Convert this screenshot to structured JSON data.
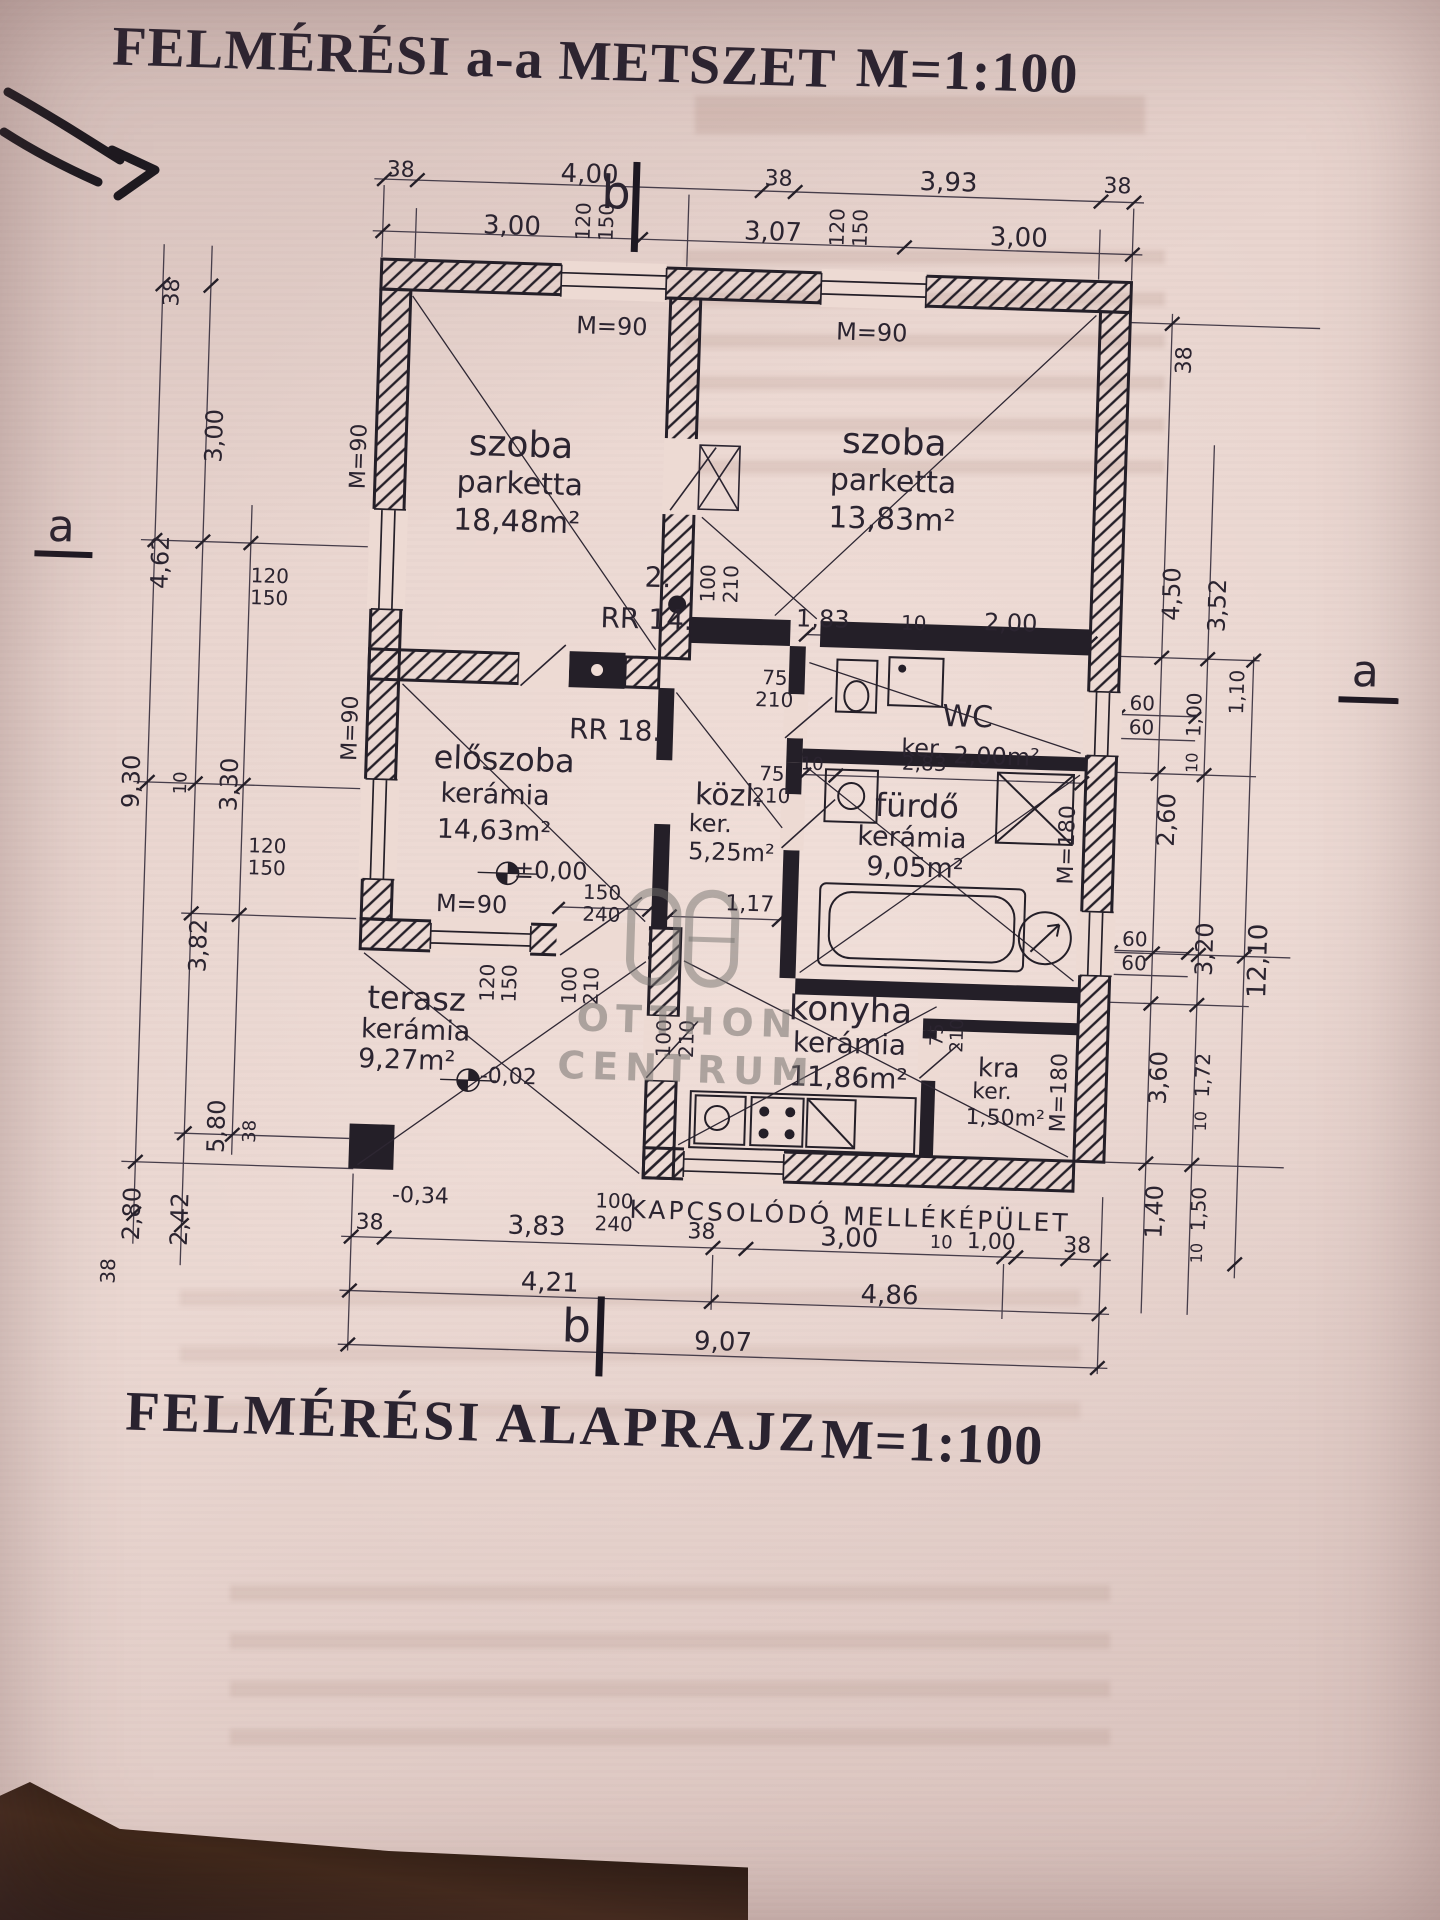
{
  "titles": {
    "top": "FELMÉRÉSI  a-a METSZET",
    "top_scale": "M=1:100",
    "bottom": "FELMÉRÉSI ALAPRAJZ",
    "bottom_scale": "M=1:100"
  },
  "watermark": {
    "word1": "OTTHON",
    "word2": "CENTRUM"
  },
  "plan_labels": [
    {
      "name": "dim-top-38-1",
      "text": "38",
      "x": 376,
      "y": 181,
      "size": 22
    },
    {
      "name": "dim-top-400",
      "text": "4,00",
      "x": 565,
      "y": 179,
      "size": 26
    },
    {
      "name": "dim-top-38-2",
      "text": "38",
      "x": 754,
      "y": 178,
      "size": 22
    },
    {
      "name": "dim-top-393",
      "text": "3,93",
      "x": 924,
      "y": 176,
      "size": 26
    },
    {
      "name": "dim-top-38-3",
      "text": "38",
      "x": 1093,
      "y": 175,
      "size": 22
    },
    {
      "name": "dim-top-300-1",
      "text": "3,00",
      "x": 489,
      "y": 233,
      "size": 26
    },
    {
      "name": "dim-top-307",
      "text": "3,07",
      "x": 750,
      "y": 231,
      "size": 26
    },
    {
      "name": "dim-top-300-2",
      "text": "3,00",
      "x": 996,
      "y": 229,
      "size": 26
    },
    {
      "name": "marker-b-top",
      "text": "b",
      "x": 592,
      "y": 196,
      "size": 46,
      "cls": "hand"
    },
    {
      "name": "win-top-left-120",
      "text": "120",
      "x": 560,
      "y": 226,
      "rot": 1,
      "size": 20
    },
    {
      "name": "win-top-left-150",
      "text": "150",
      "x": 583,
      "y": 226,
      "rot": 1,
      "size": 20
    },
    {
      "name": "win-top-right-120",
      "text": "120",
      "x": 814,
      "y": 224,
      "rot": 1,
      "size": 20
    },
    {
      "name": "win-top-right-150",
      "text": "150",
      "x": 837,
      "y": 224,
      "rot": 1,
      "size": 20
    },
    {
      "name": "lintel-top-left",
      "text": "M=90",
      "x": 592,
      "y": 330,
      "size": 24
    },
    {
      "name": "lintel-top-right",
      "text": "M=90",
      "x": 852,
      "y": 328,
      "size": 24
    },
    {
      "name": "dim-left-38-1",
      "text": "38",
      "x": 152,
      "y": 310,
      "rot": 1,
      "size": 22
    },
    {
      "name": "dim-left-300",
      "text": "3,00",
      "x": 198,
      "y": 452,
      "rot": 1,
      "size": 24
    },
    {
      "name": "dim-left-462",
      "text": "4,62",
      "x": 148,
      "y": 580,
      "rot": 1,
      "size": 24
    },
    {
      "name": "win-left-upper-120",
      "text": "120",
      "x": 258,
      "y": 590,
      "size": 20
    },
    {
      "name": "win-left-upper-150",
      "text": "150",
      "x": 258,
      "y": 612,
      "size": 20
    },
    {
      "name": "dim-left-930",
      "text": "9,30",
      "x": 126,
      "y": 800,
      "rot": 1,
      "size": 24
    },
    {
      "name": "dim-left-10",
      "text": "10",
      "x": 176,
      "y": 800,
      "rot": 1,
      "size": 18
    },
    {
      "name": "dim-left-330",
      "text": "3,30",
      "x": 224,
      "y": 800,
      "rot": 1,
      "size": 24
    },
    {
      "name": "win-left-lower-120",
      "text": "120",
      "x": 264,
      "y": 860,
      "size": 20
    },
    {
      "name": "win-left-lower-150",
      "text": "150",
      "x": 264,
      "y": 882,
      "size": 20
    },
    {
      "name": "dim-left-382",
      "text": "3,82",
      "x": 198,
      "y": 962,
      "rot": 1,
      "size": 24
    },
    {
      "name": "dim-left-580",
      "text": "5,80",
      "x": 222,
      "y": 1142,
      "rot": 1,
      "size": 24
    },
    {
      "name": "dim-left-38-2",
      "text": "38",
      "x": 256,
      "y": 1146,
      "rot": 1,
      "size": 18
    },
    {
      "name": "dim-left-280",
      "text": "2,80",
      "x": 140,
      "y": 1232,
      "rot": 1,
      "size": 24
    },
    {
      "name": "dim-left-242",
      "text": "2,42",
      "x": 188,
      "y": 1236,
      "rot": 1,
      "size": 24
    },
    {
      "name": "dim-left-38-3",
      "text": "38",
      "x": 118,
      "y": 1290,
      "rot": 1,
      "size": 20
    },
    {
      "name": "marker-a-left",
      "text": "a",
      "x": 48,
      "y": 548,
      "size": 44,
      "cls": "hand"
    },
    {
      "name": "wall-left-M90-upper",
      "text": "M=90",
      "x": 344,
      "y": 468,
      "rot": 1,
      "size": 22
    },
    {
      "name": "wall-left-M90-lower",
      "text": "M=90",
      "x": 344,
      "y": 740,
      "rot": 1,
      "size": 22
    },
    {
      "name": "dim-right-38",
      "text": "38",
      "x": 1166,
      "y": 346,
      "rot": 1,
      "size": 22
    },
    {
      "name": "dim-right-450",
      "text": "4,50",
      "x": 1160,
      "y": 580,
      "rot": 1,
      "size": 24
    },
    {
      "name": "dim-right-352",
      "text": "3,52",
      "x": 1206,
      "y": 590,
      "rot": 1,
      "size": 24
    },
    {
      "name": "win-right-wc-60a",
      "text": "60",
      "x": 1134,
      "y": 690,
      "size": 20
    },
    {
      "name": "win-right-wc-60b",
      "text": "60",
      "x": 1134,
      "y": 714,
      "size": 20
    },
    {
      "name": "dim-right-100",
      "text": "1,00",
      "x": 1186,
      "y": 700,
      "rot": 1,
      "size": 20
    },
    {
      "name": "dim-right-110",
      "text": "1,10",
      "x": 1228,
      "y": 676,
      "rot": 1,
      "size": 20
    },
    {
      "name": "dim-right-10-1",
      "text": "10",
      "x": 1186,
      "y": 748,
      "rot": 1,
      "size": 16
    },
    {
      "name": "dim-right-260",
      "text": "2,60",
      "x": 1162,
      "y": 806,
      "rot": 1,
      "size": 24
    },
    {
      "name": "win-right-k-60a",
      "text": "60",
      "x": 1134,
      "y": 926,
      "size": 20
    },
    {
      "name": "win-right-k-60b",
      "text": "60",
      "x": 1134,
      "y": 950,
      "size": 20
    },
    {
      "name": "dim-right-320",
      "text": "3,20",
      "x": 1204,
      "y": 934,
      "rot": 1,
      "size": 24
    },
    {
      "name": "dim-right-1210",
      "text": "12,10",
      "x": 1258,
      "y": 944,
      "rot": 1,
      "size": 26
    },
    {
      "name": "dim-right-360",
      "text": "3,60",
      "x": 1162,
      "y": 1064,
      "rot": 1,
      "size": 24
    },
    {
      "name": "dim-right-172",
      "text": "1,72",
      "x": 1206,
      "y": 1060,
      "rot": 1,
      "size": 20
    },
    {
      "name": "dim-right-10-2",
      "text": "10",
      "x": 1206,
      "y": 1106,
      "rot": 1,
      "size": 16
    },
    {
      "name": "dim-right-140",
      "text": "1,40",
      "x": 1162,
      "y": 1198,
      "rot": 1,
      "size": 24
    },
    {
      "name": "dim-right-150",
      "text": "1,50",
      "x": 1206,
      "y": 1194,
      "rot": 1,
      "size": 20
    },
    {
      "name": "dim-right-10-3",
      "text": "10",
      "x": 1206,
      "y": 1238,
      "rot": 1,
      "size": 16
    },
    {
      "name": "marker-a-right",
      "text": "a",
      "x": 1356,
      "y": 652,
      "size": 44,
      "cls": "hand"
    },
    {
      "name": "dim-bot-38-1",
      "text": "38",
      "x": 378,
      "y": 1234,
      "size": 22
    },
    {
      "name": "dim-bot-383",
      "text": "3,83",
      "x": 545,
      "y": 1232,
      "size": 26
    },
    {
      "name": "dim-bot-38-2",
      "text": "38",
      "x": 710,
      "y": 1233,
      "size": 22
    },
    {
      "name": "dim-bot-300",
      "text": "3,00",
      "x": 858,
      "y": 1234,
      "size": 26
    },
    {
      "name": "dim-bot-10",
      "text": "10",
      "x": 950,
      "y": 1236,
      "size": 18
    },
    {
      "name": "dim-bot-100",
      "text": "1,00",
      "x": 1000,
      "y": 1234,
      "size": 22
    },
    {
      "name": "dim-bot-38-3",
      "text": "38",
      "x": 1086,
      "y": 1235,
      "size": 22
    },
    {
      "name": "dim-bot-421",
      "text": "4,21",
      "x": 560,
      "y": 1288,
      "size": 26
    },
    {
      "name": "dim-bot-486",
      "text": "4,86",
      "x": 900,
      "y": 1290,
      "size": 26
    },
    {
      "name": "dim-bot-907",
      "text": "9,07",
      "x": 735,
      "y": 1342,
      "size": 26
    },
    {
      "name": "marker-b-bottom",
      "text": "b",
      "x": 588,
      "y": 1330,
      "size": 46,
      "cls": "hand"
    },
    {
      "name": "room-szoba-left-name",
      "text": "szoba",
      "x": 505,
      "y": 452,
      "size": 36
    },
    {
      "name": "room-szoba-left-floor",
      "text": "parketta",
      "x": 505,
      "y": 491,
      "size": 30
    },
    {
      "name": "room-szoba-left-area",
      "text": "18,48m²",
      "x": 503,
      "y": 529,
      "size": 30
    },
    {
      "name": "room-szoba-right-name",
      "text": "szoba",
      "x": 878,
      "y": 438,
      "size": 36
    },
    {
      "name": "room-szoba-right-floor",
      "text": "parketta",
      "x": 878,
      "y": 477,
      "size": 30
    },
    {
      "name": "room-szoba-right-area",
      "text": "13,83m²",
      "x": 878,
      "y": 515,
      "size": 30
    },
    {
      "name": "note-2",
      "text": "2.",
      "x": 646,
      "y": 580,
      "size": 28
    },
    {
      "name": "note-rr14",
      "text": "RR 14.",
      "x": 636,
      "y": 622,
      "size": 28
    },
    {
      "name": "door-center-100",
      "text": "100",
      "x": 696,
      "y": 584,
      "rot": 1,
      "size": 20
    },
    {
      "name": "door-center-210",
      "text": "210",
      "x": 719,
      "y": 584,
      "rot": 1,
      "size": 20
    },
    {
      "name": "dim-inner-183",
      "text": "1,83",
      "x": 812,
      "y": 616,
      "size": 24
    },
    {
      "name": "dim-inner-10",
      "text": "10",
      "x": 903,
      "y": 617,
      "size": 20
    },
    {
      "name": "dim-inner-200",
      "text": "2,00",
      "x": 1000,
      "y": 614,
      "size": 24
    },
    {
      "name": "door-wc-75",
      "text": "75",
      "x": 766,
      "y": 676,
      "size": 20
    },
    {
      "name": "door-wc-210",
      "text": "210",
      "x": 766,
      "y": 698,
      "size": 20
    },
    {
      "name": "room-wc-name",
      "text": "WC",
      "x": 960,
      "y": 710,
      "size": 30
    },
    {
      "name": "room-wc-floor",
      "text": "ker.",
      "x": 916,
      "y": 742,
      "size": 24
    },
    {
      "name": "room-wc-area",
      "text": "2,00m²",
      "x": 990,
      "y": 748,
      "size": 24
    },
    {
      "name": "room-furdo-name",
      "text": "fürdő",
      "x": 912,
      "y": 800,
      "size": 32
    },
    {
      "name": "room-furdo-floor",
      "text": "kerámia",
      "x": 908,
      "y": 832,
      "size": 27
    },
    {
      "name": "room-furdo-area",
      "text": "9,05m²",
      "x": 912,
      "y": 862,
      "size": 27
    },
    {
      "name": "door-furdo-75",
      "text": "75",
      "x": 766,
      "y": 772,
      "size": 20
    },
    {
      "name": "door-furdo-210",
      "text": "210",
      "x": 766,
      "y": 794,
      "size": 20
    },
    {
      "name": "dim-furdo-10",
      "text": "10",
      "x": 806,
      "y": 762,
      "size": 18
    },
    {
      "name": "dim-furdo-283",
      "text": "2,83",
      "x": 918,
      "y": 757,
      "size": 20
    },
    {
      "name": "win-furdo-M180",
      "text": "M=180",
      "x": 1064,
      "y": 834,
      "rot": 1,
      "size": 22
    },
    {
      "name": "room-kozl-name",
      "text": "közl.",
      "x": 724,
      "y": 796,
      "size": 30
    },
    {
      "name": "room-kozl-floor",
      "text": "ker.",
      "x": 706,
      "y": 824,
      "size": 24
    },
    {
      "name": "room-kozl-area",
      "text": "5,25m²",
      "x": 728,
      "y": 852,
      "size": 24
    },
    {
      "name": "dim-kozl-117",
      "text": "1,17",
      "x": 748,
      "y": 904,
      "size": 22
    },
    {
      "name": "note-rr18",
      "text": "RR 18.",
      "x": 608,
      "y": 734,
      "size": 28
    },
    {
      "name": "room-eloszoba-name",
      "text": "előszoba",
      "x": 498,
      "y": 766,
      "size": 32
    },
    {
      "name": "room-eloszoba-floor",
      "text": "kerámia",
      "x": 490,
      "y": 802,
      "size": 27
    },
    {
      "name": "room-eloszoba-area",
      "text": "14,63m²",
      "x": 490,
      "y": 838,
      "size": 27
    },
    {
      "name": "level-plusminus-000",
      "text": "±0,00",
      "x": 548,
      "y": 876,
      "size": 24
    },
    {
      "name": "door-eloszoba-M90",
      "text": "M=90",
      "x": 470,
      "y": 912,
      "size": 24
    },
    {
      "name": "door-elo-150",
      "text": "150",
      "x": 600,
      "y": 896,
      "size": 20
    },
    {
      "name": "door-elo-240",
      "text": "240",
      "x": 600,
      "y": 918,
      "size": 20
    },
    {
      "name": "room-terasz-name",
      "text": "terasz",
      "x": 418,
      "y": 1008,
      "size": 32
    },
    {
      "name": "room-terasz-floor",
      "text": "kerámia",
      "x": 418,
      "y": 1040,
      "size": 27
    },
    {
      "name": "room-terasz-area",
      "text": "9,27m²",
      "x": 410,
      "y": 1070,
      "size": 27
    },
    {
      "name": "level-minus-002",
      "text": "-0,02",
      "x": 512,
      "y": 1084,
      "size": 22
    },
    {
      "name": "level-minus-034",
      "text": "-0,34",
      "x": 428,
      "y": 1206,
      "size": 22
    },
    {
      "name": "win-terasz-120",
      "text": "120",
      "x": 488,
      "y": 990,
      "rot": 1,
      "size": 20
    },
    {
      "name": "win-terasz-150",
      "text": "150",
      "x": 510,
      "y": 990,
      "rot": 1,
      "size": 20
    },
    {
      "name": "door-terasz-100",
      "text": "100",
      "x": 570,
      "y": 990,
      "rot": 1,
      "size": 20
    },
    {
      "name": "door-terasz-210",
      "text": "210",
      "x": 592,
      "y": 990,
      "rot": 1,
      "size": 20
    },
    {
      "name": "room-konyha-name",
      "text": "konyha",
      "x": 852,
      "y": 1006,
      "size": 34
    },
    {
      "name": "room-konyha-floor",
      "text": "kerámia",
      "x": 852,
      "y": 1040,
      "size": 28
    },
    {
      "name": "room-konyha-area",
      "text": "11,86m²",
      "x": 852,
      "y": 1074,
      "size": 28
    },
    {
      "name": "door-konyha-100",
      "text": "100",
      "x": 666,
      "y": 1040,
      "rot": 1,
      "size": 20
    },
    {
      "name": "door-konyha-210",
      "text": "210",
      "x": 689,
      "y": 1040,
      "rot": 1,
      "size": 20
    },
    {
      "name": "door-konyha2-100",
      "text": "100",
      "x": 622,
      "y": 1204,
      "size": 20
    },
    {
      "name": "door-konyha2-240",
      "text": "240",
      "x": 622,
      "y": 1227,
      "size": 20
    },
    {
      "name": "room-kamra-name",
      "text": "kra",
      "x": 1002,
      "y": 1060,
      "size": 26
    },
    {
      "name": "room-kamra-floor",
      "text": "ker.",
      "x": 996,
      "y": 1084,
      "size": 22
    },
    {
      "name": "room-kamra-area",
      "text": "1,50m²",
      "x": 1010,
      "y": 1110,
      "size": 22
    },
    {
      "name": "door-kamra-75",
      "text": "75",
      "x": 940,
      "y": 1028,
      "rot": 1,
      "size": 18
    },
    {
      "name": "door-kamra-210",
      "text": "210",
      "x": 960,
      "y": 1028,
      "rot": 1,
      "size": 18
    },
    {
      "name": "win-kamra-M180",
      "text": "M=180",
      "x": 1064,
      "y": 1082,
      "rot": 1,
      "size": 22
    },
    {
      "name": "note-mellekepulet",
      "text": "KAPCSOLÓDÓ MELLÉKÉPÜLET",
      "x": 858,
      "y": 1212,
      "size": 25,
      "cls": "spread"
    }
  ]
}
